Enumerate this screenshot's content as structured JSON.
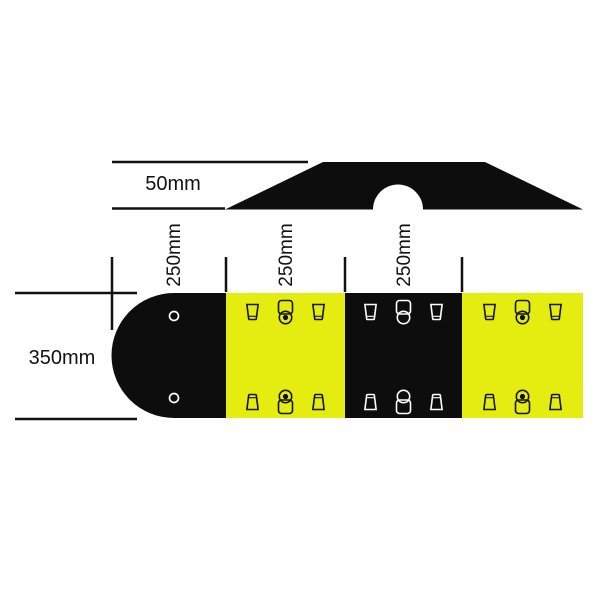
{
  "colors": {
    "background": "#ffffff",
    "rubber_black": "#0d0d0d",
    "safety_yellow": "#e4ed0f",
    "icon_outline_on_black": "#ffffff",
    "icon_outline_on_yellow": "#141414",
    "dimension_line": "#111111",
    "text": "#111111"
  },
  "side_profile": {
    "height_label": "50mm"
  },
  "plan_view": {
    "width_label": "350mm",
    "module_width_labels": [
      "250mm",
      "250mm",
      "250mm"
    ],
    "sections": [
      {
        "id": "end-cap",
        "color": "black",
        "fixings": "two-round-holes"
      },
      {
        "id": "module-1",
        "color": "yellow",
        "fixings": "slot-bolt-slot"
      },
      {
        "id": "module-2",
        "color": "black",
        "fixings": "slot-bolt-slot"
      },
      {
        "id": "module-3",
        "color": "yellow",
        "fixings": "slot-bolt-slot"
      }
    ]
  },
  "icon_layout": {
    "top_row": [
      "slot-icon",
      "bolt-icon",
      "slot-icon"
    ],
    "bottom_row": [
      "slot-icon",
      "bolt-icon",
      "slot-icon"
    ]
  }
}
